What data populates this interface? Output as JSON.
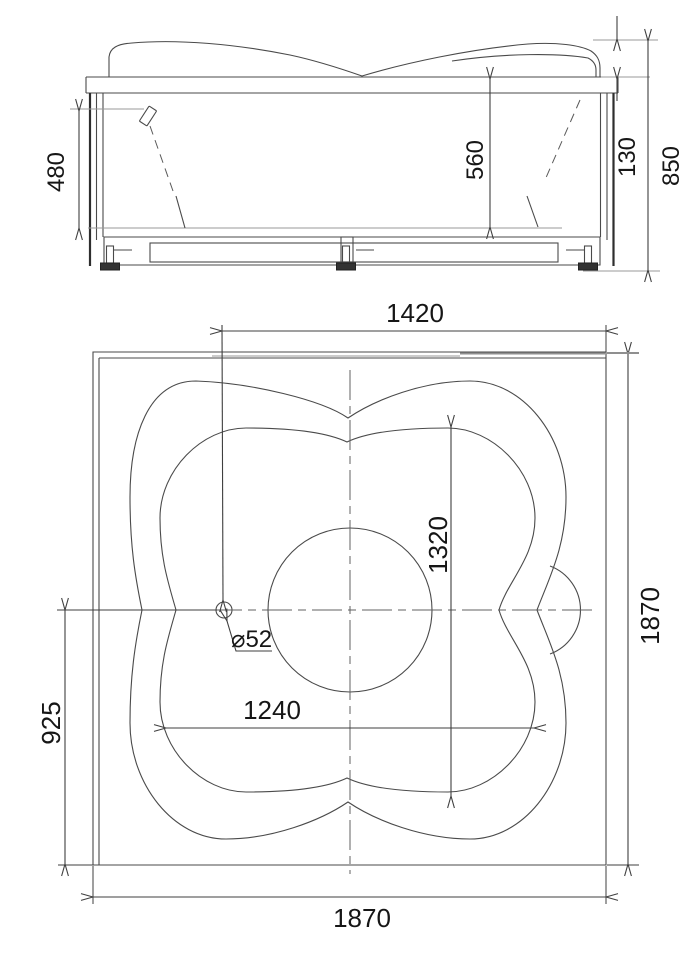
{
  "colors": {
    "background": "#ffffff",
    "line": "#4a4a4a",
    "dimension_line": "#3f3f3f",
    "text": "#161616",
    "reference_line": "#999999"
  },
  "side_view": {
    "dim_480": "480",
    "dim_560": "560",
    "dim_130": "130",
    "dim_850": "850"
  },
  "plan_view": {
    "dim_1420": "1420",
    "dim_1320": "1320",
    "dim_1240": "1240",
    "dim_925": "925",
    "dim_1870_right": "1870",
    "dim_1870_bottom": "1870",
    "drain_diameter": "⌀52"
  }
}
